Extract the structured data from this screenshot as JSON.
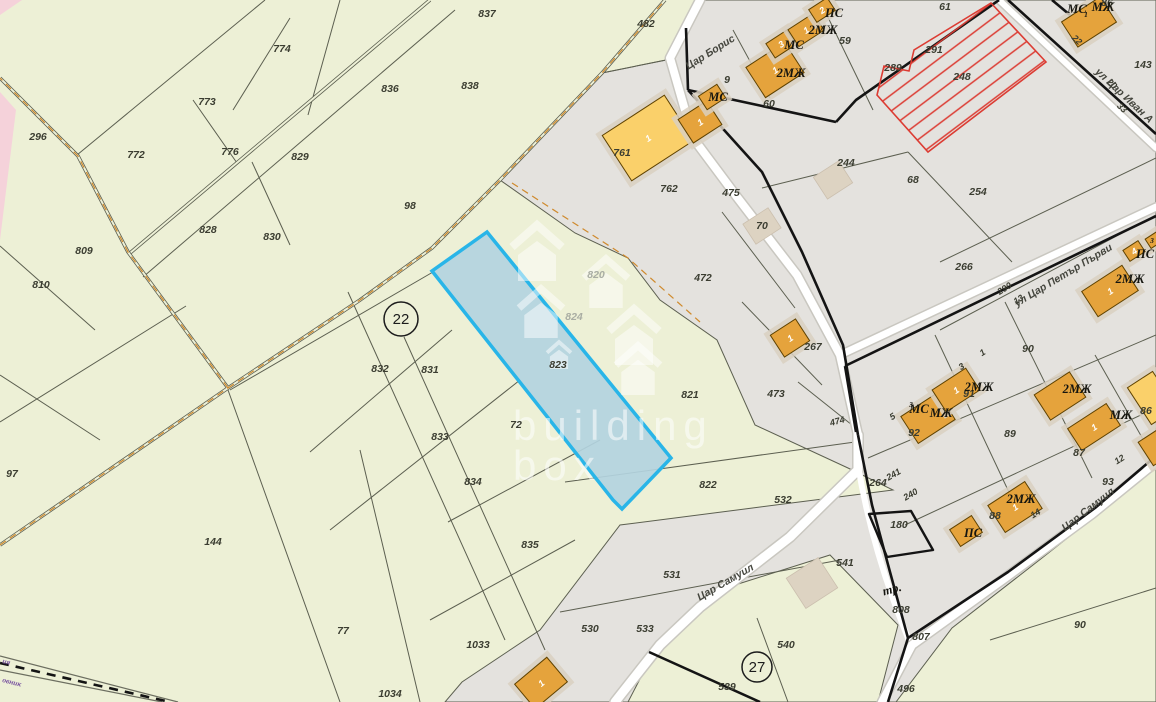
{
  "app": {
    "watermark_line1": "building",
    "watermark_line2": "box"
  },
  "colors": {
    "rural_fill": "#edf0d6",
    "urban_fill": "#e4e2de",
    "pink_fill": "#f5d2da",
    "road_white": "#ffffff",
    "road_casing": "#c9c7c0",
    "line_thin": "#5c5f50",
    "line_thick": "#141414",
    "track_dash_orange": "#cf8a2d",
    "building_orange": "#e5a33c",
    "building_yellow": "#fad06a",
    "building_stroke": "#5f4200",
    "building_halo": "#d9d0c1",
    "building_beige": "#ddd3c2",
    "selected_fill": "#b3d4e0",
    "selected_stroke": "#29b5e8",
    "hatch_red": "#dc3c33",
    "label_dark": "#3b3d31",
    "label_faded": "#a9ada3",
    "boundary_purple": "#7a55a0"
  },
  "map": {
    "selected_parcel": {
      "id": "823"
    },
    "restricted_parcel": {
      "id": "248"
    },
    "markers": [
      {
        "value": "22"
      },
      {
        "value": "27"
      }
    ],
    "parcel_labels": [
      {
        "t": "837",
        "x": 487,
        "y": 17
      },
      {
        "t": "774",
        "x": 282,
        "y": 52
      },
      {
        "t": "773",
        "x": 207,
        "y": 105
      },
      {
        "t": "836",
        "x": 390,
        "y": 92
      },
      {
        "t": "838",
        "x": 470,
        "y": 89
      },
      {
        "t": "296",
        "x": 38,
        "y": 140
      },
      {
        "t": "772",
        "x": 136,
        "y": 158
      },
      {
        "t": "776",
        "x": 230,
        "y": 155
      },
      {
        "t": "829",
        "x": 300,
        "y": 160
      },
      {
        "t": "98",
        "x": 410,
        "y": 209
      },
      {
        "t": "828",
        "x": 208,
        "y": 233
      },
      {
        "t": "830",
        "x": 272,
        "y": 240
      },
      {
        "t": "809",
        "x": 84,
        "y": 254
      },
      {
        "t": "810",
        "x": 41,
        "y": 288
      },
      {
        "t": "97",
        "x": 12,
        "y": 477
      },
      {
        "t": "144",
        "x": 213,
        "y": 545
      },
      {
        "t": "77",
        "x": 343,
        "y": 634
      },
      {
        "t": "832",
        "x": 380,
        "y": 372
      },
      {
        "t": "831",
        "x": 430,
        "y": 373
      },
      {
        "t": "833",
        "x": 440,
        "y": 440
      },
      {
        "t": "834",
        "x": 473,
        "y": 485
      },
      {
        "t": "835",
        "x": 530,
        "y": 548
      },
      {
        "t": "1033",
        "x": 478,
        "y": 648
      },
      {
        "t": "1034",
        "x": 390,
        "y": 697
      },
      {
        "t": "72",
        "x": 516,
        "y": 428
      },
      {
        "t": "823",
        "x": 558,
        "y": 368
      },
      {
        "t": "821",
        "x": 690,
        "y": 398
      },
      {
        "t": "822",
        "x": 708,
        "y": 488
      },
      {
        "t": "482",
        "x": 646,
        "y": 27
      },
      {
        "t": "539",
        "x": 727,
        "y": 690
      },
      {
        "t": "540",
        "x": 786,
        "y": 648
      },
      {
        "t": "496",
        "x": 906,
        "y": 692
      },
      {
        "t": "90",
        "x": 1080,
        "y": 628
      },
      {
        "t": "9",
        "x": 727,
        "y": 83
      },
      {
        "t": "59",
        "x": 845,
        "y": 44
      },
      {
        "t": "60",
        "x": 769,
        "y": 107
      },
      {
        "t": "61",
        "x": 945,
        "y": 10
      },
      {
        "t": "291",
        "x": 934,
        "y": 53
      },
      {
        "t": "289",
        "x": 893,
        "y": 71
      },
      {
        "t": "248",
        "x": 962,
        "y": 80
      },
      {
        "t": "244",
        "x": 846,
        "y": 166
      },
      {
        "t": "143",
        "x": 1143,
        "y": 68
      },
      {
        "t": "68",
        "x": 913,
        "y": 183
      },
      {
        "t": "254",
        "x": 978,
        "y": 195
      },
      {
        "t": "266",
        "x": 964,
        "y": 270
      },
      {
        "t": "472",
        "x": 703,
        "y": 281
      },
      {
        "t": "475",
        "x": 731,
        "y": 196
      },
      {
        "t": "70",
        "x": 762,
        "y": 229
      },
      {
        "t": "761",
        "x": 622,
        "y": 156
      },
      {
        "t": "762",
        "x": 669,
        "y": 192
      },
      {
        "t": "267",
        "x": 813,
        "y": 350
      },
      {
        "t": "473",
        "x": 776,
        "y": 397
      },
      {
        "t": "90",
        "x": 1028,
        "y": 352
      },
      {
        "t": "91",
        "x": 969,
        "y": 397
      },
      {
        "t": "92",
        "x": 914,
        "y": 436
      },
      {
        "t": "89",
        "x": 1010,
        "y": 437
      },
      {
        "t": "87",
        "x": 1079,
        "y": 456
      },
      {
        "t": "88",
        "x": 995,
        "y": 519
      },
      {
        "t": "93",
        "x": 1108,
        "y": 485
      },
      {
        "t": "86",
        "x": 1146,
        "y": 414
      },
      {
        "t": "86",
        "x": 1107,
        "y": 6
      },
      {
        "t": "531",
        "x": 672,
        "y": 578
      },
      {
        "t": "532",
        "x": 783,
        "y": 503
      },
      {
        "t": "533",
        "x": 645,
        "y": 632
      },
      {
        "t": "530",
        "x": 590,
        "y": 632
      },
      {
        "t": "541",
        "x": 845,
        "y": 566
      },
      {
        "t": "180",
        "x": 899,
        "y": 528
      },
      {
        "t": "808",
        "x": 901,
        "y": 613
      },
      {
        "t": "807",
        "x": 921,
        "y": 640
      },
      {
        "t": "264",
        "x": 878,
        "y": 486
      }
    ],
    "faded_labels": [
      {
        "t": "820",
        "x": 596,
        "y": 278
      },
      {
        "t": "824",
        "x": 574,
        "y": 320
      }
    ],
    "small_labels": [
      {
        "t": "5",
        "x": 894,
        "y": 419,
        "r": -32
      },
      {
        "t": "3",
        "x": 963,
        "y": 369,
        "r": -32
      },
      {
        "t": "1",
        "x": 984,
        "y": 355,
        "r": -32
      },
      {
        "t": "12",
        "x": 1121,
        "y": 462,
        "r": -32
      },
      {
        "t": "14",
        "x": 1037,
        "y": 516,
        "r": -32
      },
      {
        "t": "13",
        "x": 1020,
        "y": 302,
        "r": -32
      },
      {
        "t": "20",
        "x": 1110,
        "y": 86,
        "r": 43
      },
      {
        "t": "33",
        "x": 1120,
        "y": 110,
        "r": 43
      },
      {
        "t": "22",
        "x": 1075,
        "y": 42,
        "r": 43
      },
      {
        "t": "290",
        "x": 1006,
        "y": 291,
        "r": -32
      },
      {
        "t": "241",
        "x": 895,
        "y": 477,
        "r": -30
      },
      {
        "t": "240",
        "x": 912,
        "y": 497,
        "r": -30
      },
      {
        "t": "474",
        "x": 838,
        "y": 424,
        "r": -15
      }
    ],
    "street_labels": [
      {
        "t": "Цар Борис",
        "x": 712,
        "y": 55,
        "r": -32
      },
      {
        "t": "ул Цар Петър Първи",
        "x": 1065,
        "y": 278,
        "r": -31
      },
      {
        "t": "Цар Самуил",
        "x": 727,
        "y": 585,
        "r": -30
      },
      {
        "t": "Цар Самуил",
        "x": 1090,
        "y": 512,
        "r": -38
      },
      {
        "t": "ул Цар Иван А",
        "x": 1122,
        "y": 98,
        "r": 43
      }
    ],
    "building_labels": [
      {
        "t": "МС",
        "x": 718,
        "y": 101
      },
      {
        "t": "2МЖ",
        "x": 791,
        "y": 77
      },
      {
        "t": "МС",
        "x": 794,
        "y": 49
      },
      {
        "t": "2МЖ",
        "x": 823,
        "y": 34
      },
      {
        "t": "ПС",
        "x": 834,
        "y": 17
      },
      {
        "t": "МС",
        "x": 1077,
        "y": 13
      },
      {
        "t": "МЖ",
        "x": 1103,
        "y": 11
      },
      {
        "t": "МС",
        "x": 919,
        "y": 413
      },
      {
        "t": "МЖ",
        "x": 941,
        "y": 417
      },
      {
        "t": "2МЖ",
        "x": 979,
        "y": 391
      },
      {
        "t": "2МЖ",
        "x": 1077,
        "y": 393
      },
      {
        "t": "МЖ",
        "x": 1121,
        "y": 419
      },
      {
        "t": "2МЖ",
        "x": 1021,
        "y": 503
      },
      {
        "t": "ПС",
        "x": 973,
        "y": 537
      },
      {
        "t": "2МЖ",
        "x": 1130,
        "y": 283
      },
      {
        "t": "ПС",
        "x": 1145,
        "y": 258
      },
      {
        "t": "тр.",
        "x": 893,
        "y": 593,
        "r": -15
      }
    ],
    "building_sub_labels": [
      {
        "t": "1",
        "x": 1086,
        "y": 17
      },
      {
        "t": "3",
        "x": 911,
        "y": 407
      },
      {
        "t": "3",
        "x": 1152,
        "y": 243
      }
    ],
    "boundary_labels": [
      {
        "t": "ия",
        "x": 2,
        "y": 663,
        "r": 14
      },
      {
        "t": "овник",
        "x": 2,
        "y": 682,
        "r": 14
      }
    ],
    "buildings": [
      {
        "x": 648,
        "y": 138,
        "w": 74,
        "h": 54,
        "r": -33,
        "type": "y",
        "num": "1",
        "nc": "#3a2c00"
      },
      {
        "x": 700,
        "y": 122,
        "w": 34,
        "h": 28,
        "r": -33,
        "type": "o",
        "num": "1"
      },
      {
        "x": 712,
        "y": 97,
        "w": 22,
        "h": 16,
        "r": -33,
        "type": "o"
      },
      {
        "x": 775,
        "y": 70,
        "w": 46,
        "h": 36,
        "r": -33,
        "type": "o",
        "num": "1"
      },
      {
        "x": 781,
        "y": 44,
        "w": 25,
        "h": 17,
        "r": -33,
        "type": "o",
        "num": "3"
      },
      {
        "x": 806,
        "y": 30,
        "w": 30,
        "h": 20,
        "r": -33,
        "type": "o",
        "num": "1"
      },
      {
        "x": 822,
        "y": 10,
        "w": 22,
        "h": 15,
        "r": -33,
        "type": "o",
        "num": "2"
      },
      {
        "x": 1089,
        "y": 22,
        "w": 46,
        "h": 30,
        "r": -33,
        "type": "o"
      },
      {
        "x": 790,
        "y": 338,
        "w": 30,
        "h": 26,
        "r": -33,
        "type": "o",
        "num": "1"
      },
      {
        "x": 928,
        "y": 418,
        "w": 44,
        "h": 32,
        "r": -33,
        "type": "o"
      },
      {
        "x": 956,
        "y": 390,
        "w": 40,
        "h": 26,
        "r": -33,
        "type": "o",
        "num": "1"
      },
      {
        "x": 1060,
        "y": 396,
        "w": 42,
        "h": 30,
        "r": -33,
        "type": "o"
      },
      {
        "x": 1094,
        "y": 427,
        "w": 46,
        "h": 26,
        "r": -33,
        "type": "o",
        "num": "1"
      },
      {
        "x": 1015,
        "y": 507,
        "w": 44,
        "h": 32,
        "r": -33,
        "type": "o",
        "num": "1"
      },
      {
        "x": 966,
        "y": 531,
        "w": 26,
        "h": 20,
        "r": -33,
        "type": "o"
      },
      {
        "x": 1152,
        "y": 398,
        "w": 30,
        "h": 44,
        "r": -33,
        "type": "y"
      },
      {
        "x": 1155,
        "y": 448,
        "w": 22,
        "h": 28,
        "r": -33,
        "type": "o"
      },
      {
        "x": 1110,
        "y": 291,
        "w": 48,
        "h": 30,
        "r": -33,
        "type": "o",
        "num": "1"
      },
      {
        "x": 1134,
        "y": 251,
        "w": 18,
        "h": 13,
        "r": -33,
        "type": "o",
        "num": "4"
      },
      {
        "x": 1154,
        "y": 240,
        "w": 14,
        "h": 11,
        "r": -33,
        "type": "o"
      },
      {
        "x": 541,
        "y": 683,
        "w": 42,
        "h": 32,
        "r": -40,
        "type": "o",
        "num": "1"
      },
      {
        "x": 762,
        "y": 226,
        "w": 30,
        "h": 24,
        "r": -33,
        "type": "b"
      },
      {
        "x": 833,
        "y": 180,
        "w": 30,
        "h": 26,
        "r": -33,
        "type": "b"
      },
      {
        "x": 812,
        "y": 583,
        "w": 38,
        "h": 36,
        "r": -33,
        "type": "b"
      }
    ],
    "watermark_houses": [
      {
        "x": 537,
        "y": 256,
        "s": 50
      },
      {
        "x": 606,
        "y": 286,
        "s": 44
      },
      {
        "x": 541,
        "y": 316,
        "s": 44
      },
      {
        "x": 634,
        "y": 340,
        "s": 50
      },
      {
        "x": 559,
        "y": 357,
        "s": 24
      },
      {
        "x": 638,
        "y": 373,
        "s": 44
      }
    ]
  }
}
